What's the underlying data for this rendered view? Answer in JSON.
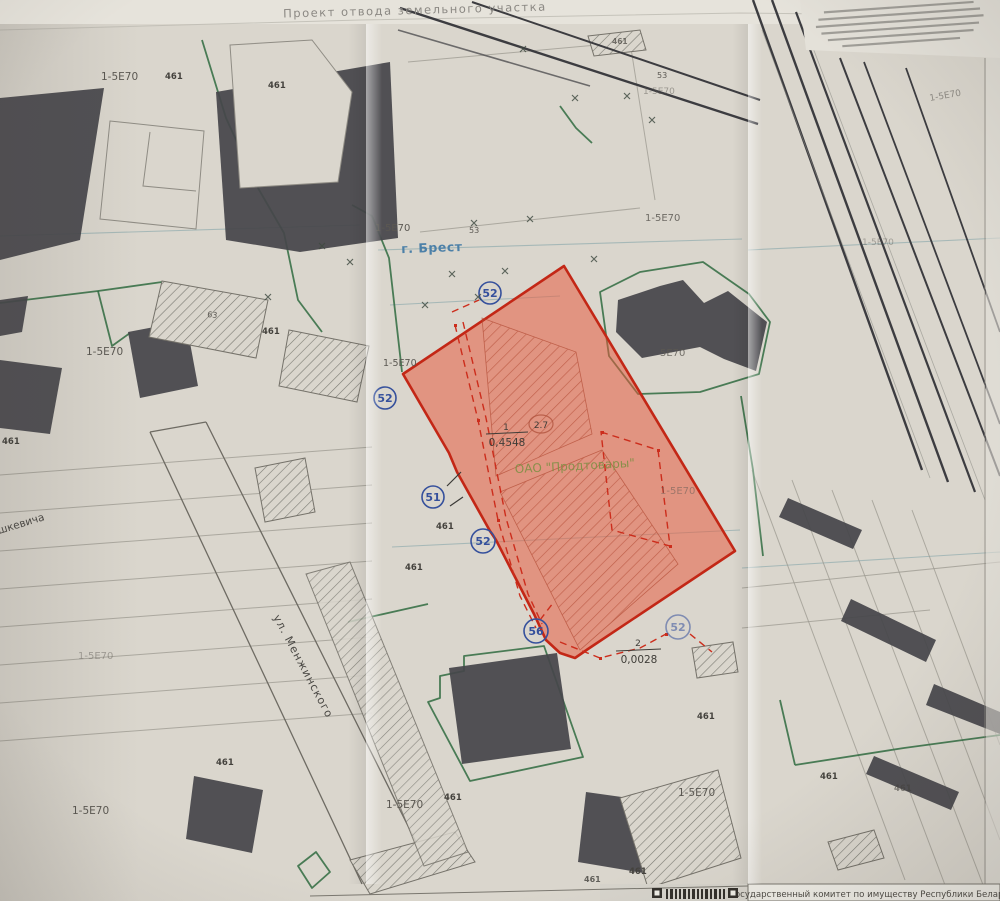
{
  "photo": {
    "title_top": "Проект отвода земельного участка",
    "bottom_bar_committee": "Государственный комитет по имуществу Республики Беларусь"
  },
  "map": {
    "city": "г. Брест",
    "organization": "ОАО \"Продтовары\"",
    "streets": [
      {
        "name": "ул. Менжинского"
      },
      {
        "name": "шкевича"
      }
    ],
    "parcel_main": {
      "number": "1",
      "area": "0,4548",
      "floors_mark": "2.7"
    },
    "parcel_secondary": {
      "number": "2",
      "area": "0,0028"
    },
    "colors": {
      "parcel_fill": "#e8593b",
      "parcel_stroke": "#c32716",
      "ink_blue": "#35509c",
      "boundary_green": "#2f6b3f",
      "org_green": "#7f8f45",
      "city_blue": "#4c80a8"
    },
    "survey_points": [
      {
        "label": "52",
        "x": 490,
        "y": 293,
        "r": 11
      },
      {
        "label": "52",
        "x": 385,
        "y": 398,
        "r": 11
      },
      {
        "label": "51",
        "x": 433,
        "y": 497,
        "r": 11
      },
      {
        "label": "52",
        "x": 483,
        "y": 541,
        "r": 12
      },
      {
        "label": "56",
        "x": 536,
        "y": 631,
        "r": 12
      },
      {
        "label": "52",
        "x": 678,
        "y": 627,
        "r": 12,
        "o": 0.55
      }
    ],
    "zone_labels": [
      {
        "t": "1-5Е70",
        "x": 101,
        "y": 80,
        "s": 10.5
      },
      {
        "t": "461",
        "x": 165,
        "y": 79,
        "s": 8.5,
        "b": 1
      },
      {
        "t": "461",
        "x": 268,
        "y": 88,
        "s": 8.5,
        "b": 1
      },
      {
        "t": "1-5Е70",
        "x": 375,
        "y": 231,
        "s": 10
      },
      {
        "t": "53",
        "x": 469,
        "y": 233,
        "s": 8
      },
      {
        "t": "461",
        "x": 612,
        "y": 44,
        "s": 7.5,
        "b": 1,
        "o": 0.7
      },
      {
        "t": "53",
        "x": 657,
        "y": 78,
        "s": 8
      },
      {
        "t": "1-5Е70",
        "x": 643,
        "y": 94,
        "s": 9,
        "o": 0.5
      },
      {
        "t": "1-5Е70",
        "x": 86,
        "y": 355,
        "s": 10.5
      },
      {
        "t": "461",
        "x": 262,
        "y": 334,
        "s": 8.5,
        "b": 1
      },
      {
        "t": "63",
        "x": 207,
        "y": 317,
        "s": 8,
        "r": 6
      },
      {
        "t": "461",
        "x": 2,
        "y": 444,
        "s": 8.5,
        "b": 1
      },
      {
        "t": "1-5Е70",
        "x": 383,
        "y": 366,
        "s": 9.5
      },
      {
        "t": "5Е70",
        "x": 660,
        "y": 356,
        "s": 10,
        "o": 0.8
      },
      {
        "t": "1-5Е70",
        "x": 645,
        "y": 221,
        "s": 10,
        "o": 0.85
      },
      {
        "t": "1-5Е70",
        "x": 660,
        "y": 494,
        "s": 10,
        "o": 0.5
      },
      {
        "t": "461",
        "x": 436,
        "y": 529,
        "s": 8.5,
        "b": 1
      },
      {
        "t": "461",
        "x": 405,
        "y": 570,
        "s": 8.5,
        "b": 1
      },
      {
        "t": "1-5Е70",
        "x": 78,
        "y": 659,
        "s": 10,
        "o": 0.45
      },
      {
        "t": "1-5Е70",
        "x": 72,
        "y": 814,
        "s": 10.5
      },
      {
        "t": "461",
        "x": 216,
        "y": 765,
        "s": 8.5,
        "b": 1
      },
      {
        "t": "1-5Е70",
        "x": 386,
        "y": 808,
        "s": 10.5
      },
      {
        "t": "461",
        "x": 444,
        "y": 800,
        "s": 8.5,
        "b": 1
      },
      {
        "t": "461",
        "x": 697,
        "y": 719,
        "s": 8.5,
        "b": 1
      },
      {
        "t": "1-5Е70",
        "x": 678,
        "y": 796,
        "s": 10.5
      },
      {
        "t": "461",
        "x": 629,
        "y": 874,
        "s": 8.5,
        "b": 1
      },
      {
        "t": "461",
        "x": 584,
        "y": 882,
        "s": 8,
        "b": 1,
        "o": 0.8
      },
      {
        "t": "461",
        "x": 820,
        "y": 779,
        "s": 8.5,
        "b": 1
      },
      {
        "t": "461",
        "x": 894,
        "y": 791,
        "s": 8.5,
        "b": 1,
        "o": 0.6
      },
      {
        "t": "1-5Е70",
        "x": 930,
        "y": 101,
        "s": 9,
        "r": -10,
        "o": 0.6
      },
      {
        "t": "1-5Е70",
        "x": 862,
        "y": 245,
        "s": 9,
        "o": 0.45
      }
    ],
    "boundary_marks": [
      {
        "x": 322,
        "y": 246
      },
      {
        "x": 268,
        "y": 297
      },
      {
        "x": 425,
        "y": 305
      },
      {
        "x": 452,
        "y": 274
      },
      {
        "x": 505,
        "y": 271
      },
      {
        "x": 474,
        "y": 223
      },
      {
        "x": 530,
        "y": 219
      },
      {
        "x": 478,
        "y": 297
      },
      {
        "x": 575,
        "y": 98
      },
      {
        "x": 627,
        "y": 96
      },
      {
        "x": 652,
        "y": 120
      },
      {
        "x": 523,
        "y": 49
      },
      {
        "x": 594,
        "y": 259
      },
      {
        "x": 350,
        "y": 262
      }
    ]
  }
}
